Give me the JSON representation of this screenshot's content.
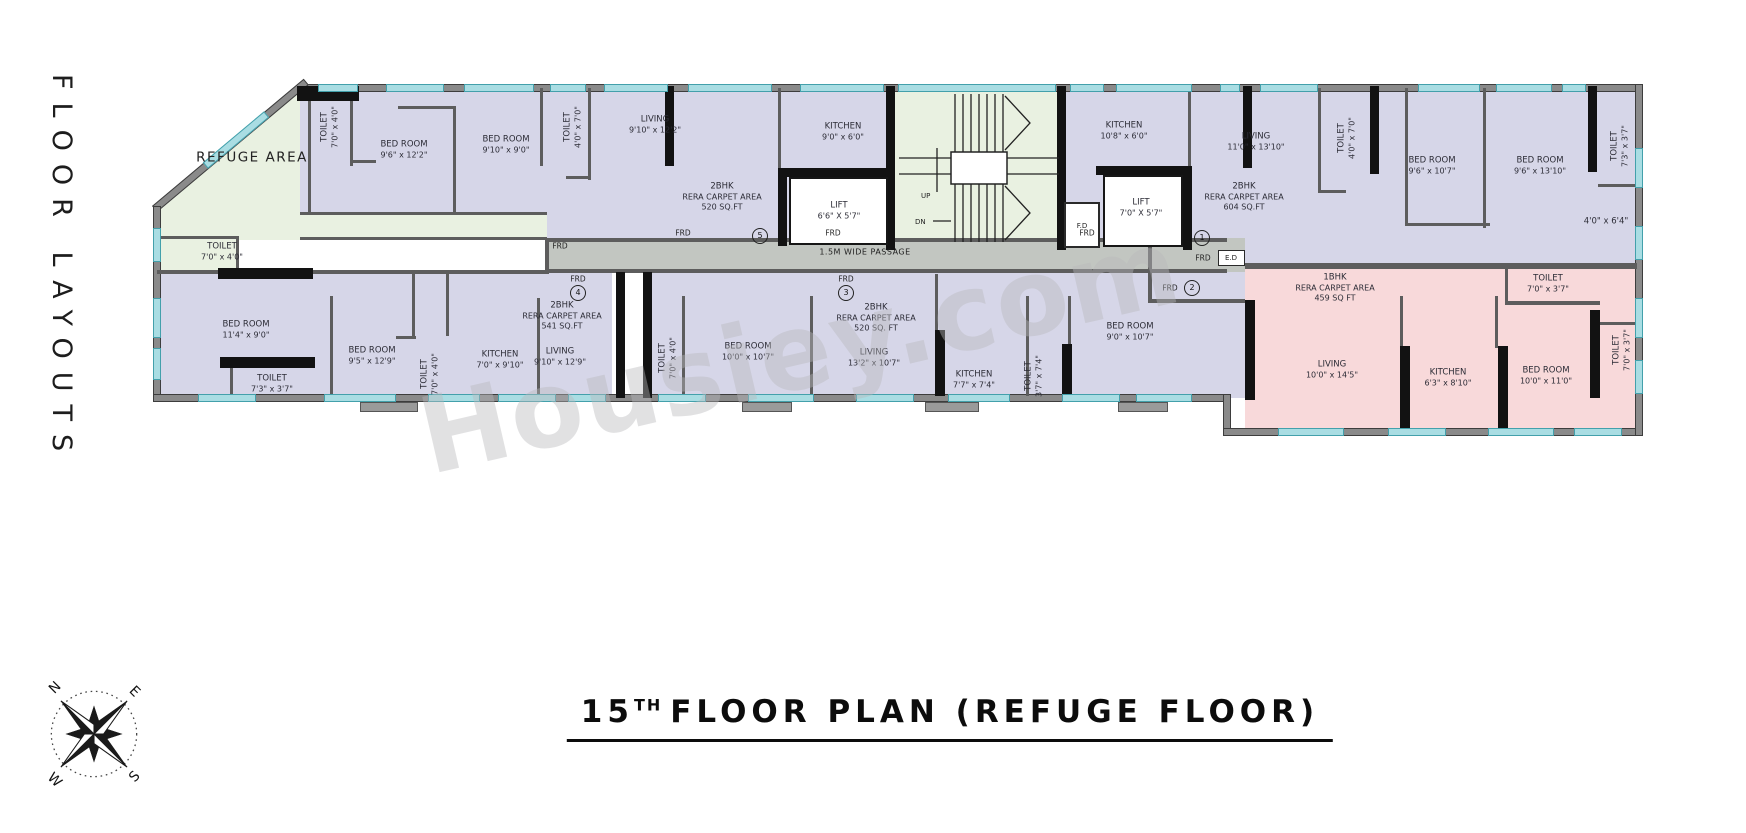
{
  "page": {
    "left_caption": "FLOOR LAYOUTS",
    "watermark": "Housiey.com",
    "title": {
      "number": "15",
      "sup": "TH",
      "rest": "FLOOR PLAN (REFUGE FLOOR)"
    }
  },
  "compass": {
    "n": "N",
    "e": "E",
    "s": "S",
    "w": "W"
  },
  "colors": {
    "unit_purple": "#d6d6e8",
    "refuge_green": "#e9f1e1",
    "unit_pink": "#f8d9da",
    "passage_gray": "#c2c6c1",
    "window_teal": "#a9dde3"
  },
  "plan": {
    "passage": {
      "label": "1.5M WIDE PASSAGE"
    },
    "stairs": {
      "up": "UP",
      "down": "DN"
    },
    "small_rooms": {
      "fd": "F.D",
      "ed": "E.D"
    },
    "frd": {
      "label": "FRD",
      "positions": [
        {
          "x": 560,
          "y": 246
        },
        {
          "x": 683,
          "y": 233
        },
        {
          "x": 833,
          "y": 233
        },
        {
          "x": 1087,
          "y": 233
        },
        {
          "x": 578,
          "y": 279
        },
        {
          "x": 846,
          "y": 279
        },
        {
          "x": 1203,
          "y": 258
        },
        {
          "x": 1170,
          "y": 288
        }
      ]
    },
    "unit_markers": [
      {
        "n": "5",
        "x": 760,
        "y": 236
      },
      {
        "n": "4",
        "x": 578,
        "y": 293
      },
      {
        "n": "3",
        "x": 846,
        "y": 293
      },
      {
        "n": "1",
        "x": 1202,
        "y": 238
      },
      {
        "n": "2",
        "x": 1192,
        "y": 288
      }
    ],
    "rooms": [
      {
        "lines": [
          "REFUGE AREA"
        ],
        "x": 252,
        "y": 158,
        "cls": "big"
      },
      {
        "lines": [
          "TOILET",
          "7'0\" x 4'0\""
        ],
        "x": 222,
        "y": 252
      },
      {
        "lines": [
          "TOILET",
          "7'0\" x 4'0\""
        ],
        "x": 330,
        "y": 127,
        "v": 1
      },
      {
        "lines": [
          "BED ROOM",
          "9'6\" x 12'2\""
        ],
        "x": 404,
        "y": 150
      },
      {
        "lines": [
          "BED ROOM",
          "9'10\" x 9'0\""
        ],
        "x": 506,
        "y": 145
      },
      {
        "lines": [
          "TOILET",
          "4'0\" x 7'0\""
        ],
        "x": 573,
        "y": 127,
        "v": 1
      },
      {
        "lines": [
          "LIVING",
          "9'10\" x 12'2\""
        ],
        "x": 655,
        "y": 125
      },
      {
        "lines": [
          "KITCHEN",
          "9'0\" x 6'0\""
        ],
        "x": 843,
        "y": 132
      },
      {
        "lines": [
          "2BHK",
          "RERA CARPET AREA",
          "520 SQ.FT"
        ],
        "x": 722,
        "y": 197
      },
      {
        "lines": [
          "LIFT",
          "6'6\" X 5'7\""
        ],
        "x": 839,
        "y": 211
      },
      {
        "lines": [
          "KITCHEN",
          "10'8\" x 6'0\""
        ],
        "x": 1124,
        "y": 131
      },
      {
        "lines": [
          "LIVING",
          "11'0\" x 13'10\""
        ],
        "x": 1256,
        "y": 142
      },
      {
        "lines": [
          "2BHK",
          "RERA CARPET AREA",
          "604 SQ.FT"
        ],
        "x": 1244,
        "y": 197
      },
      {
        "lines": [
          "LIFT",
          "7'0\" X 5'7\""
        ],
        "x": 1141,
        "y": 208
      },
      {
        "lines": [
          "TOILET",
          "4'0\" x 7'0\""
        ],
        "x": 1347,
        "y": 138,
        "v": 1
      },
      {
        "lines": [
          "BED ROOM",
          "9'6\" x 10'7\""
        ],
        "x": 1432,
        "y": 166
      },
      {
        "lines": [
          "BED ROOM",
          "9'6\" x 13'10\""
        ],
        "x": 1540,
        "y": 166
      },
      {
        "lines": [
          "TOILET",
          "7'3\" x 3'7\""
        ],
        "x": 1620,
        "y": 146,
        "v": 1
      },
      {
        "lines": [
          "4'0\" x 6'4\""
        ],
        "x": 1606,
        "y": 222
      },
      {
        "lines": [
          "BED ROOM",
          "11'4\" x 9'0\""
        ],
        "x": 246,
        "y": 330
      },
      {
        "lines": [
          "TOILET",
          "7'3\" x 3'7\""
        ],
        "x": 272,
        "y": 384
      },
      {
        "lines": [
          "BED ROOM",
          "9'5\" x 12'9\""
        ],
        "x": 372,
        "y": 356
      },
      {
        "lines": [
          "TOILET",
          "7'0\" x 4'0\""
        ],
        "x": 430,
        "y": 374,
        "v": 1
      },
      {
        "lines": [
          "KITCHEN",
          "7'0\" x 9'10\""
        ],
        "x": 500,
        "y": 360
      },
      {
        "lines": [
          "2BHK",
          "RERA CARPET AREA",
          "541 SQ.FT"
        ],
        "x": 562,
        "y": 316
      },
      {
        "lines": [
          "LIVING",
          "9'10\" x 12'9\""
        ],
        "x": 560,
        "y": 357
      },
      {
        "lines": [
          "TOILET",
          "7'0\" x 4'0\""
        ],
        "x": 668,
        "y": 358,
        "v": 1
      },
      {
        "lines": [
          "BED ROOM",
          "10'0\" x 10'7\""
        ],
        "x": 748,
        "y": 352
      },
      {
        "lines": [
          "2BHK",
          "RERA CARPET AREA",
          "520 SQ. FT"
        ],
        "x": 876,
        "y": 318
      },
      {
        "lines": [
          "LIVING",
          "13'2\" x 10'7\""
        ],
        "x": 874,
        "y": 358
      },
      {
        "lines": [
          "KITCHEN",
          "7'7\" x 7'4\""
        ],
        "x": 974,
        "y": 380
      },
      {
        "lines": [
          "TOILET",
          "3'7\" x 7'4\""
        ],
        "x": 1034,
        "y": 376,
        "v": 1
      },
      {
        "lines": [
          "BED ROOM",
          "9'0\" x 10'7\""
        ],
        "x": 1130,
        "y": 332
      },
      {
        "lines": [
          "1BHK",
          "RERA CARPET AREA",
          "459 SQ FT"
        ],
        "x": 1335,
        "y": 288
      },
      {
        "lines": [
          "LIVING",
          "10'0\" x 14'5\""
        ],
        "x": 1332,
        "y": 370
      },
      {
        "lines": [
          "KITCHEN",
          "6'3\" x 8'10\""
        ],
        "x": 1448,
        "y": 378
      },
      {
        "lines": [
          "BED ROOM",
          "10'0\" x 11'0\""
        ],
        "x": 1546,
        "y": 376
      },
      {
        "lines": [
          "TOILET",
          "7'0\" x 3'7\""
        ],
        "x": 1548,
        "y": 284
      },
      {
        "lines": [
          "TOILET",
          "7'0\" x 3'7\""
        ],
        "x": 1622,
        "y": 350,
        "v": 1
      }
    ]
  }
}
